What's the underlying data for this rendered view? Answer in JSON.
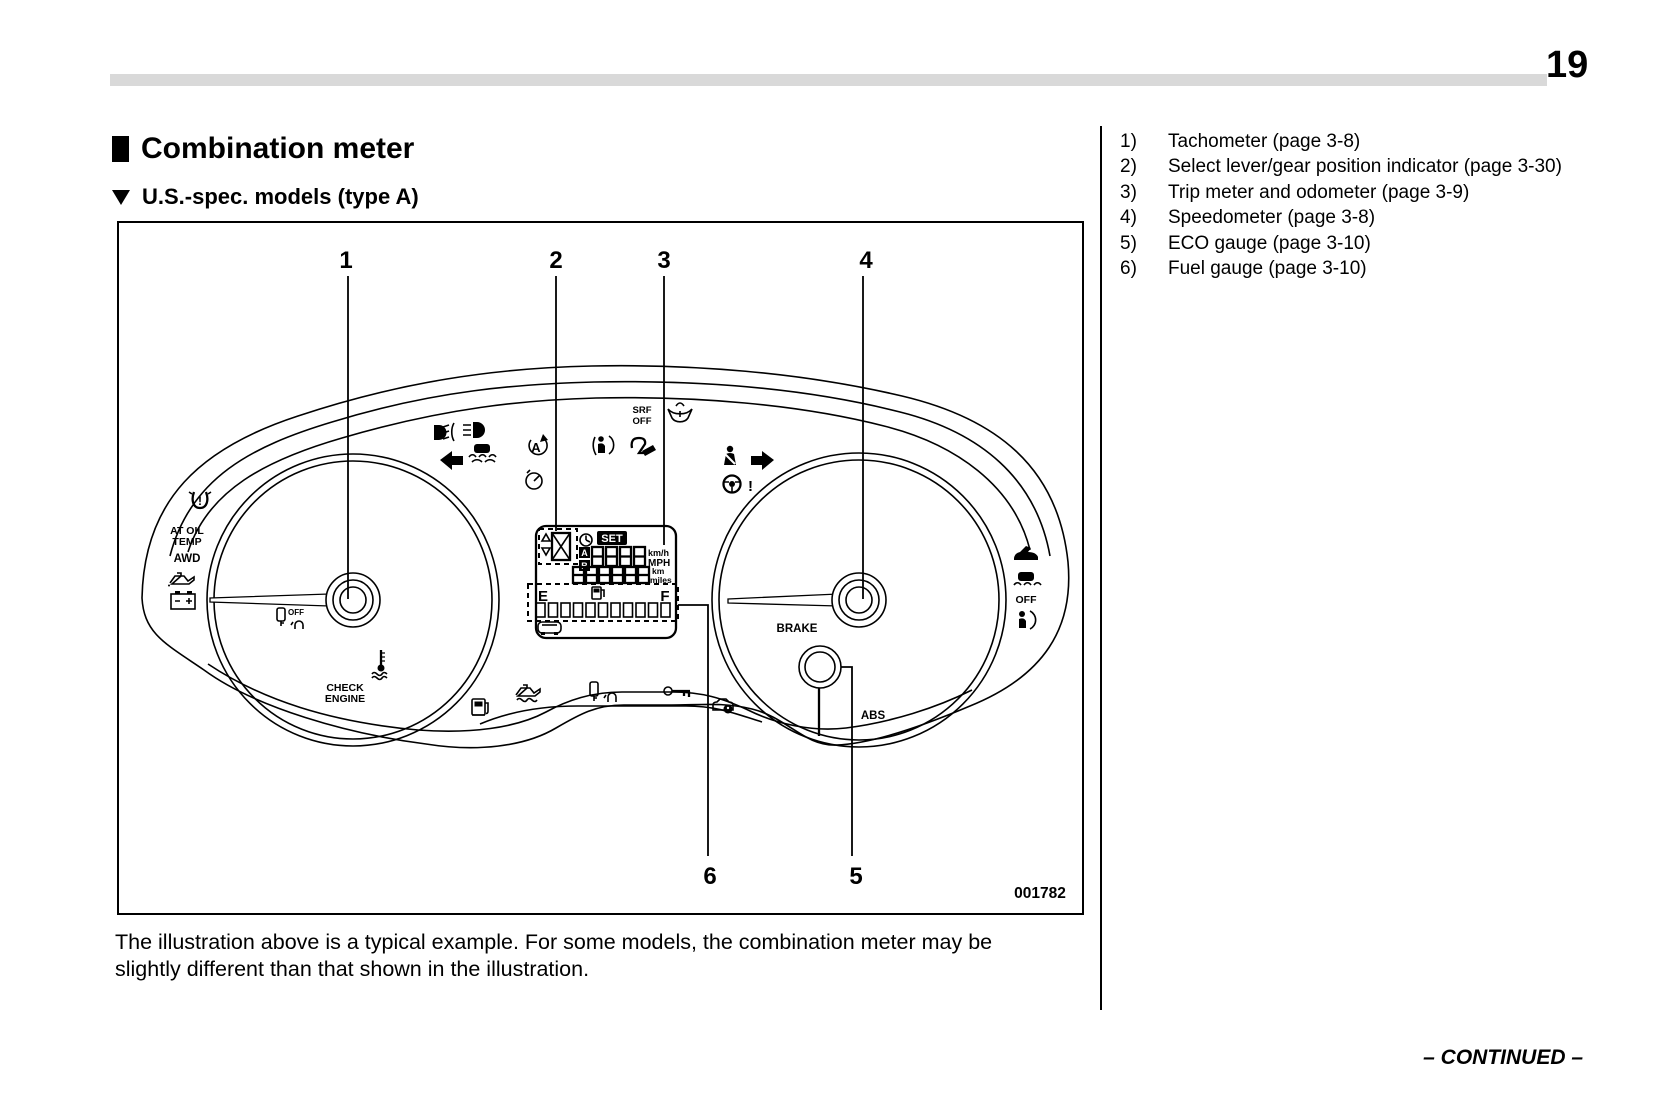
{
  "page": {
    "number": "19"
  },
  "colors": {
    "ink": "#000000",
    "page_bg": "#ffffff",
    "header_bar": "#d9d9d9"
  },
  "header": {
    "title": "Combination meter",
    "subtitle": "U.S.-spec. models (type A)"
  },
  "legend": {
    "items": [
      {
        "num": "1)",
        "label": "Tachometer (page 3-8)"
      },
      {
        "num": "2)",
        "label": "Select lever/gear position indicator (page 3-30)"
      },
      {
        "num": "3)",
        "label": "Trip meter and odometer (page 3-9)"
      },
      {
        "num": "4)",
        "label": "Speedometer (page 3-8)"
      },
      {
        "num": "5)",
        "label": "ECO gauge (page 3-10)"
      },
      {
        "num": "6)",
        "label": "Fuel gauge (page 3-10)"
      }
    ]
  },
  "figure": {
    "code": "001782",
    "callouts": [
      "1",
      "2",
      "3",
      "4",
      "5",
      "6"
    ],
    "labels": {
      "at_oil": "AT OIL",
      "temp": "TEMP",
      "awd": "AWD",
      "check": "CHECK",
      "engine": "ENGINE",
      "brake": "BRAKE",
      "abs": "ABS",
      "srf": "SRF",
      "off_srf": "OFF",
      "off_vdc": "OFF",
      "off_key": "OFF",
      "set": "SET",
      "trip_a": "A",
      "trip_b": "B",
      "fuel_e": "E",
      "fuel_f": "F",
      "kmh": "km/h",
      "mph": "MPH",
      "km": "km",
      "miles": "miles",
      "auto_a": "A",
      "excl_tpms": "!",
      "excl_steering": "!"
    },
    "icons": [
      "tpms-warning",
      "oil-pressure",
      "charge-battery",
      "key-off",
      "engine-coolant-temp",
      "fog-lamp",
      "high-beam",
      "turn-left",
      "vdc",
      "auto-stop-start",
      "cruise",
      "passenger-airbag",
      "steering-responsive-headlight",
      "washer-fluid",
      "seatbelt",
      "turn-right",
      "steering-warning",
      "low-fuel",
      "oil-temp",
      "access-key",
      "immobilizer-key",
      "security",
      "trunk-open",
      "vdc-off",
      "airbag",
      "eco-gauge",
      "fuel-pump",
      "clock",
      "car-rear"
    ]
  },
  "caption": {
    "text": "The illustration above is a typical example. For some models, the combination meter may be slightly different than that shown in the illustration."
  },
  "footer": {
    "continued": "– CONTINUED –"
  }
}
